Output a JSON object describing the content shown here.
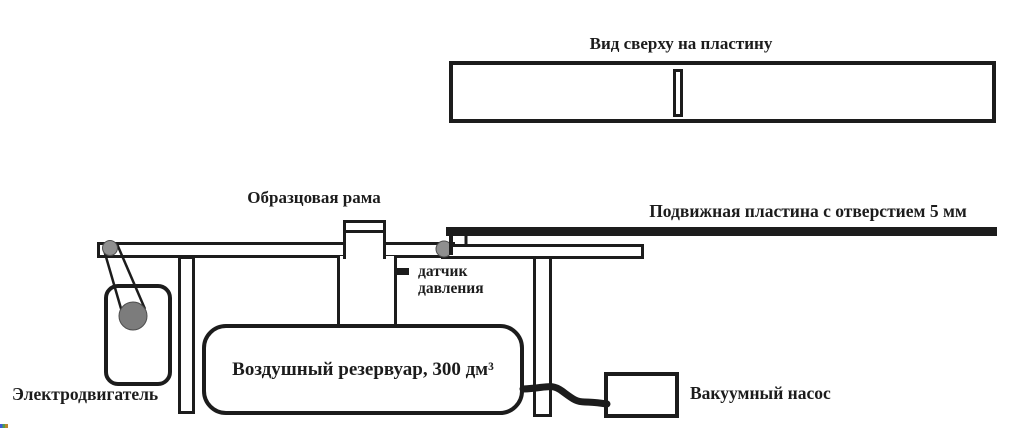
{
  "colors": {
    "line": "#1c1c1c",
    "pulley_gray": "#7c7c7c",
    "roller_gray": "#8f8f8f",
    "background": "#ffffff"
  },
  "top_view": {
    "title": "Вид сверху на пластину"
  },
  "apparatus": {
    "reference_frame_label": "Образцовая рама",
    "movable_plate_label": "Подвижная пластина с отверстием 5 мм",
    "pressure_sensor_label_line1": "датчик",
    "pressure_sensor_label_line2": "давления",
    "air_reservoir_label": "Воздушный резервуар, 300 дм³",
    "electric_motor_label": "Электродвигатель",
    "vacuum_pump_label": "Вакуумный насос"
  }
}
